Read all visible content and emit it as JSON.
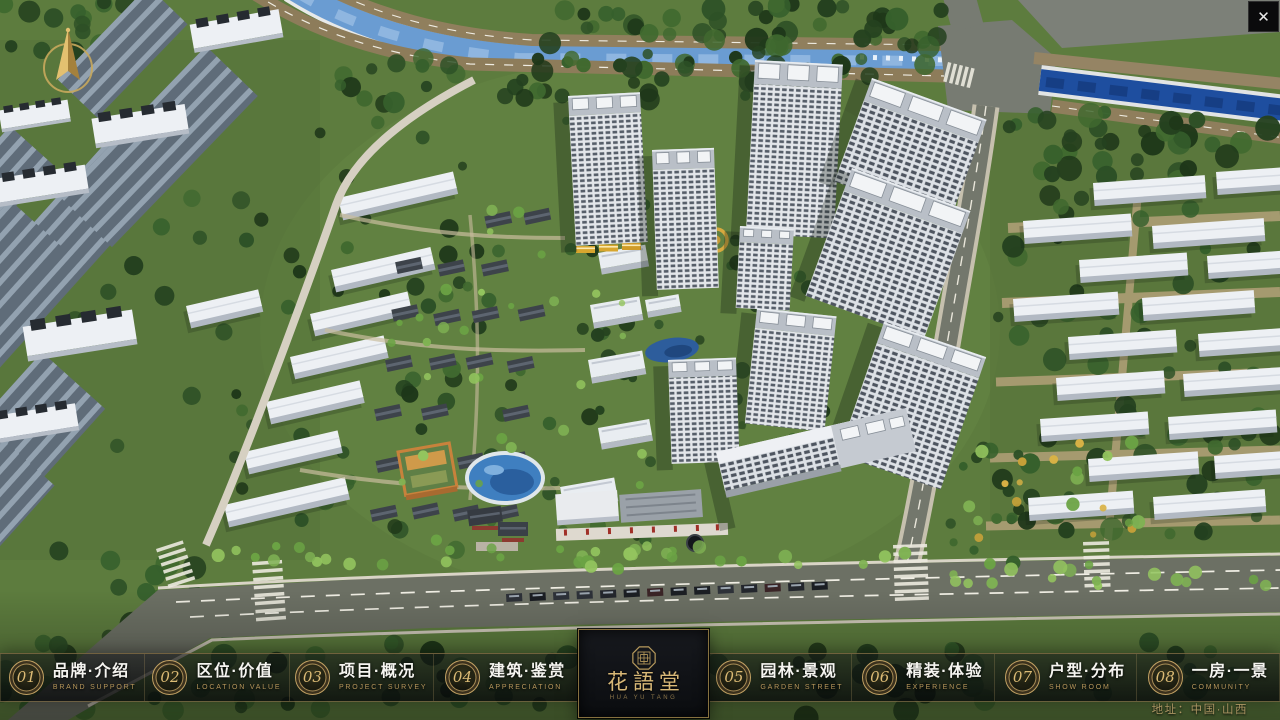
{
  "window": {
    "close_icon": "✕"
  },
  "nav": {
    "items": [
      {
        "num": "01",
        "title": "品牌·介绍",
        "subtitle": "BRAND SUPPORT"
      },
      {
        "num": "02",
        "title": "区位·价值",
        "subtitle": "LOCATION VALUE"
      },
      {
        "num": "03",
        "title": "项目·概况",
        "subtitle": "PROJECT SURVEY"
      },
      {
        "num": "04",
        "title": "建筑·鉴赏",
        "subtitle": "APPRECIATION"
      },
      {
        "num": "05",
        "title": "园林·景观",
        "subtitle": "GARDEN STREET"
      },
      {
        "num": "06",
        "title": "精装·体验",
        "subtitle": "EXPERIENCE"
      },
      {
        "num": "07",
        "title": "户型·分布",
        "subtitle": "SHOW ROOM"
      },
      {
        "num": "08",
        "title": "一房·一景",
        "subtitle": "COMMUNITY"
      }
    ]
  },
  "logo": {
    "title": "花語堂",
    "subtitle": "HUA YU TANG"
  },
  "footer": {
    "address": "地址：中国·山西"
  },
  "colors": {
    "accent_gold": "#c2a163",
    "nav_bg": "rgba(10,12,15,0.65)",
    "river_blue": "#6a9cd2",
    "canal_blue": "#1e4e9f"
  }
}
